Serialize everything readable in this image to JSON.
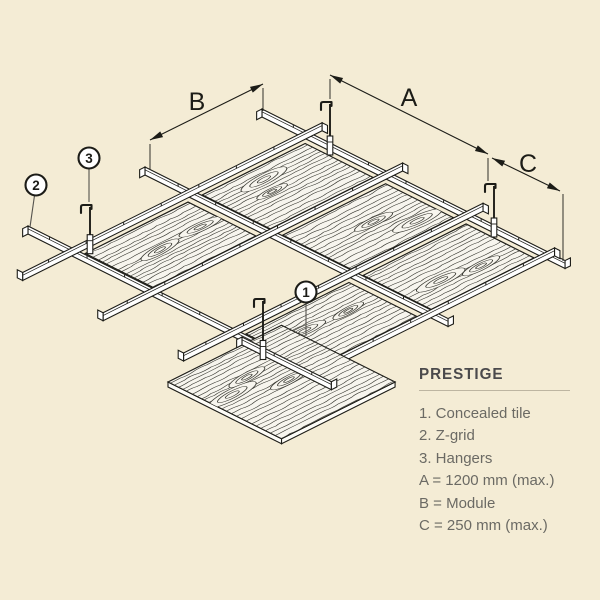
{
  "legend": {
    "title": "PRESTIGE",
    "items": [
      "1. Concealed tile",
      "2. Z-grid",
      "3. Hangers",
      "A = 1200 mm (max.)",
      "B = Module",
      "C = 250 mm (max.)"
    ]
  },
  "dimensions": {
    "a": "A",
    "b": "B",
    "c": "C"
  },
  "callouts": {
    "tile": "1",
    "zgrid": "2",
    "hangers": "3"
  },
  "colors": {
    "background": "#f4ecd5",
    "ink": "#1c1c17",
    "tile_fill": "#f7f5ee",
    "grain": "#3a3a33",
    "rail_fill": "#ffffff",
    "leader": "#55534e",
    "legend_title": "#4b4a4c",
    "legend_text": "#6b6a64",
    "legend_rule": "#bdb5a1"
  }
}
